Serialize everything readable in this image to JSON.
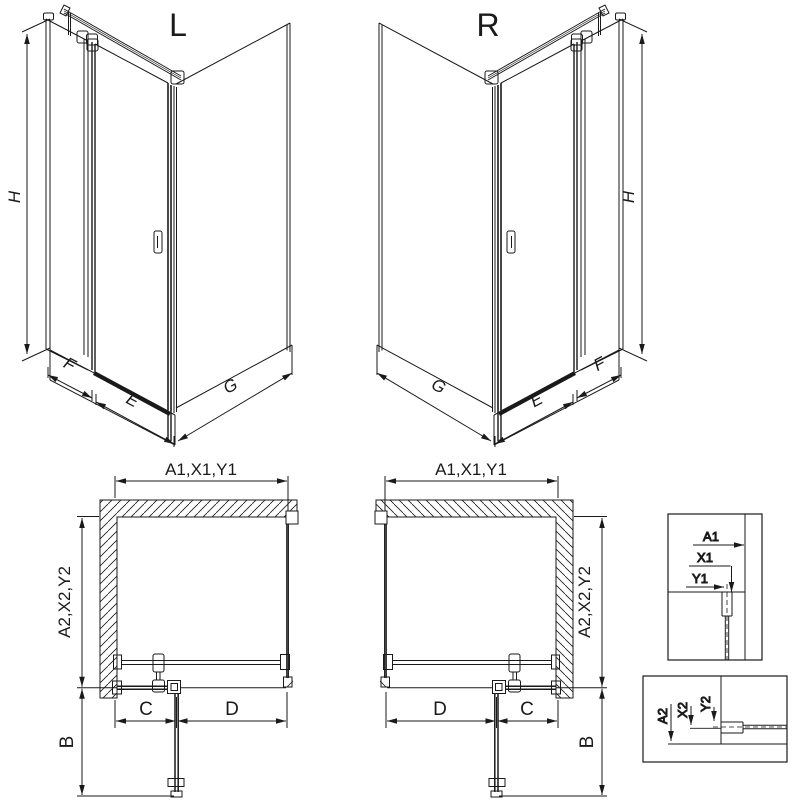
{
  "labels": {
    "left_view": "L",
    "right_view": "R"
  },
  "iso_left": {
    "height": "H",
    "fixed_panel": "F",
    "door_width": "E",
    "side_panel": "G"
  },
  "iso_right": {
    "height": "H",
    "fixed_panel": "F",
    "door_width": "E",
    "side_panel": "G"
  },
  "plan_left": {
    "width_dim": "A1,X1,Y1",
    "depth_dim": "A2,X2,Y2",
    "swing_dim": "B",
    "fixed_dim": "C",
    "door_dim": "D"
  },
  "plan_right": {
    "width_dim": "A1,X1,Y1",
    "depth_dim": "A2,X2,Y2",
    "swing_dim": "B",
    "fixed_dim": "C",
    "door_dim": "D"
  },
  "detail_width": {
    "a1": "A1",
    "x1": "X1",
    "y1": "Y1"
  },
  "detail_depth": {
    "a2": "A2",
    "x2": "X2",
    "y2": "Y2"
  },
  "colors": {
    "line": "#1a1a1a",
    "background": "#ffffff"
  }
}
